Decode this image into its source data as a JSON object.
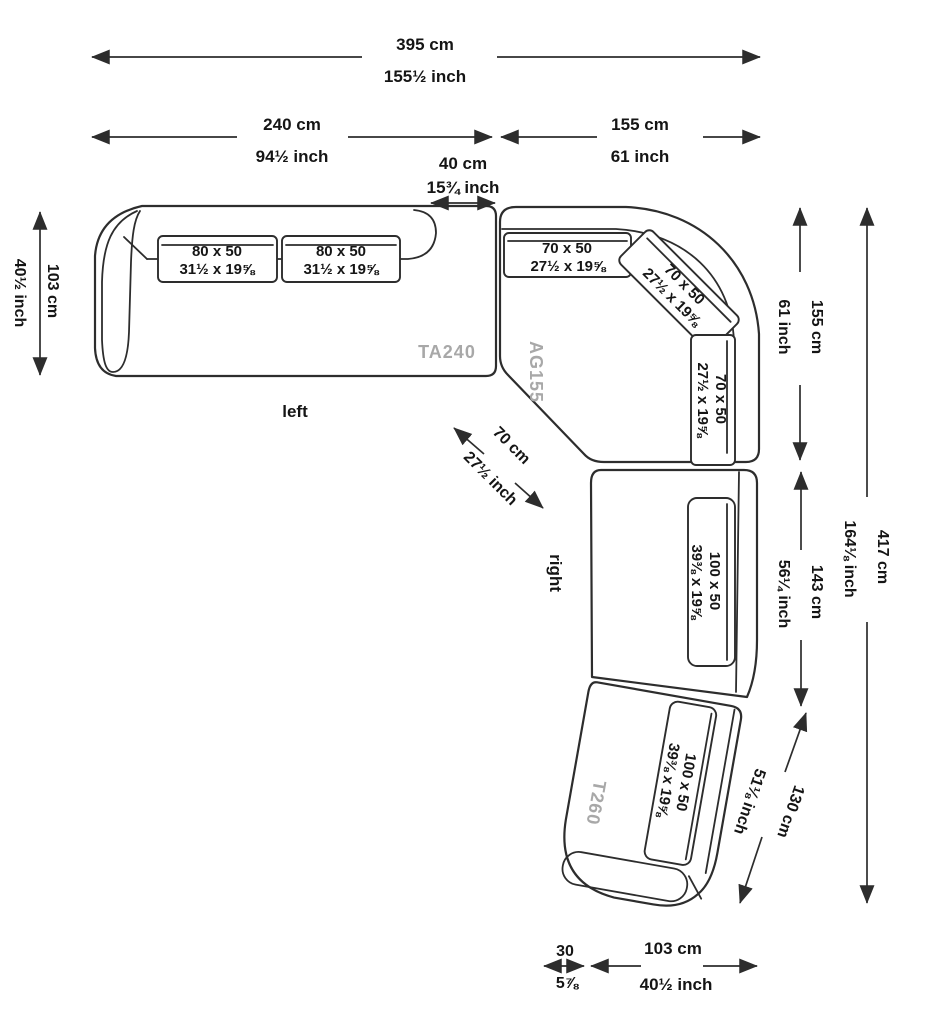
{
  "colors": {
    "background": "#ffffff",
    "line": "#2d2d2d",
    "module_label": "#a8a8a8",
    "text": "#151515"
  },
  "modules": {
    "ta240": {
      "code": "TA240",
      "orientation_label": "left"
    },
    "ag155": {
      "code": "AG155"
    },
    "t260": {
      "code": "T260",
      "orientation_label": "right"
    }
  },
  "cushions": {
    "c80": {
      "cm": "80 x 50",
      "inch": "31½ x 19⅝"
    },
    "c70": {
      "cm": "70 x 50",
      "inch": "27½ x 19⅝"
    },
    "c100": {
      "cm": "100 x 50",
      "inch": "39⅜ x 19⅝"
    }
  },
  "dimensions": {
    "total_width": {
      "cm": "395 cm",
      "inch": "155½ inch"
    },
    "left_section_width": {
      "cm": "240 cm",
      "inch": "94½ inch"
    },
    "corner_section_width": {
      "cm": "155 cm",
      "inch": "61 inch"
    },
    "connector_width": {
      "cm": "40 cm",
      "inch": "15¾ inch"
    },
    "left_section_depth": {
      "cm": "103 cm",
      "inch": "40½ inch"
    },
    "diagonal_seat_depth": {
      "cm": "70 cm",
      "inch": "27½ inch"
    },
    "corner_section_height": {
      "cm": "155 cm",
      "inch": "61 inch"
    },
    "middle_section_height": {
      "cm": "143 cm",
      "inch": "56¼ inch"
    },
    "chaise_section_length": {
      "cm": "130 cm",
      "inch": "51⅛ inch"
    },
    "total_height": {
      "cm": "417 cm",
      "inch": "164⅛ inch"
    },
    "bottom_offset": {
      "cm": "30",
      "inch": "5⅞"
    },
    "bottom_depth": {
      "cm": "103 cm",
      "inch": "40½ inch"
    }
  }
}
